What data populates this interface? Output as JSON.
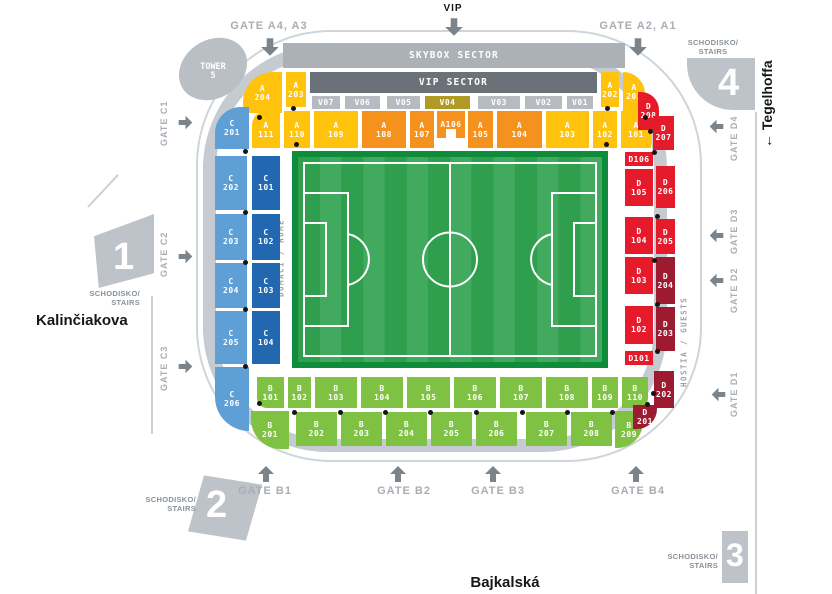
{
  "palette": {
    "yellow": "#FFC20D",
    "orange": "#F5921E",
    "olive": "#AE9A24",
    "blue_light": "#5EA0D6",
    "blue_dark": "#2268B0",
    "red": "#E51B2C",
    "maroon": "#9C1B31",
    "green": "#7EC143",
    "gray": "#B5BBC1",
    "gray_dark": "#6B7178",
    "pitch_frame": "#0E8C3C",
    "pitch_dark": "#2F9F4D",
    "pitch_light": "#42AA5E"
  },
  "streets": {
    "left": "Kalinčiakova",
    "bottom": "Bajkalská",
    "right": "← Tegelhoffa"
  },
  "vip_entrance": "VIP",
  "top_gates": {
    "left": "GATE A4, A3",
    "right": "GATE A2, A1"
  },
  "bars": {
    "skybox": "SKYBOX SECTOR",
    "vip": "VIP SECTOR"
  },
  "tower": {
    "line1": "TOWER",
    "line2": "5"
  },
  "stairs": {
    "label": "SCHODISKO/\nSTAIRS",
    "one": "1",
    "two": "2",
    "three": "3",
    "four": "4"
  },
  "side_gates": {
    "c": [
      "GATE C1",
      "GATE C2",
      "GATE C3"
    ],
    "d": [
      "GATE D4",
      "GATE D3",
      "GATE D2",
      "GATE D1"
    ],
    "b": [
      "GATE B1",
      "GATE B2",
      "GATE B3",
      "GATE B4"
    ]
  },
  "team_sides": {
    "home": "DOMÁCI / HOME",
    "guests": "HOSTIA / GUESTS"
  },
  "sections": [
    {
      "id": "A204",
      "label": "A 204",
      "color": "yellow"
    },
    {
      "id": "A203",
      "label": "A 203",
      "color": "yellow"
    },
    {
      "id": "A202",
      "label": "A 202",
      "color": "yellow"
    },
    {
      "id": "A201",
      "label": "A 201",
      "color": "yellow"
    },
    {
      "id": "A111",
      "label": "A 111",
      "color": "yellow"
    },
    {
      "id": "A110",
      "label": "A 110",
      "color": "yellow"
    },
    {
      "id": "A109",
      "label": "A 109",
      "color": "yellow"
    },
    {
      "id": "A108",
      "label": "A 108",
      "color": "orange"
    },
    {
      "id": "A107",
      "label": "A 107",
      "color": "orange"
    },
    {
      "id": "A106",
      "label": "A106",
      "color": "orange"
    },
    {
      "id": "A105",
      "label": "A 105",
      "color": "orange"
    },
    {
      "id": "A104",
      "label": "A 104",
      "color": "orange"
    },
    {
      "id": "A103",
      "label": "A 103",
      "color": "yellow"
    },
    {
      "id": "A102",
      "label": "A 102",
      "color": "yellow"
    },
    {
      "id": "A101",
      "label": "A 101",
      "color": "yellow"
    },
    {
      "id": "V07",
      "label": "V07",
      "color": "gray"
    },
    {
      "id": "V06",
      "label": "V06",
      "color": "gray"
    },
    {
      "id": "V05",
      "label": "V05",
      "color": "gray"
    },
    {
      "id": "V04",
      "label": "V04",
      "color": "olive"
    },
    {
      "id": "V03",
      "label": "V03",
      "color": "gray"
    },
    {
      "id": "V02",
      "label": "V02",
      "color": "gray"
    },
    {
      "id": "V01",
      "label": "V01",
      "color": "gray"
    },
    {
      "id": "C201",
      "label": "C 201",
      "color": "blue_light"
    },
    {
      "id": "C202",
      "label": "C 202",
      "color": "blue_light"
    },
    {
      "id": "C203",
      "label": "C 203",
      "color": "blue_light"
    },
    {
      "id": "C204",
      "label": "C 204",
      "color": "blue_light"
    },
    {
      "id": "C205",
      "label": "C 205",
      "color": "blue_light"
    },
    {
      "id": "C206",
      "label": "C 206",
      "color": "blue_light"
    },
    {
      "id": "C101",
      "label": "C 101",
      "color": "blue_dark"
    },
    {
      "id": "C102",
      "label": "C 102",
      "color": "blue_dark"
    },
    {
      "id": "C103",
      "label": "C 103",
      "color": "blue_dark"
    },
    {
      "id": "C104",
      "label": "C 104",
      "color": "blue_dark"
    },
    {
      "id": "B101",
      "label": "B 101",
      "color": "green"
    },
    {
      "id": "B102",
      "label": "B 102",
      "color": "green"
    },
    {
      "id": "B103",
      "label": "B 103",
      "color": "green"
    },
    {
      "id": "B104",
      "label": "B 104",
      "color": "green"
    },
    {
      "id": "B105",
      "label": "B 105",
      "color": "green"
    },
    {
      "id": "B106",
      "label": "B 106",
      "color": "green"
    },
    {
      "id": "B107",
      "label": "B 107",
      "color": "green"
    },
    {
      "id": "B108",
      "label": "B 108",
      "color": "green"
    },
    {
      "id": "B109",
      "label": "B 109",
      "color": "green"
    },
    {
      "id": "B110",
      "label": "B 110",
      "color": "green"
    },
    {
      "id": "B201",
      "label": "B 201",
      "color": "green"
    },
    {
      "id": "B202",
      "label": "B 202",
      "color": "green"
    },
    {
      "id": "B203",
      "label": "B 203",
      "color": "green"
    },
    {
      "id": "B204",
      "label": "B 204",
      "color": "green"
    },
    {
      "id": "B205",
      "label": "B 205",
      "color": "green"
    },
    {
      "id": "B206",
      "label": "B 206",
      "color": "green"
    },
    {
      "id": "B207",
      "label": "B 207",
      "color": "green"
    },
    {
      "id": "B208",
      "label": "B 208",
      "color": "green"
    },
    {
      "id": "B209",
      "label": "B 209",
      "color": "green"
    },
    {
      "id": "D106",
      "label": "D106",
      "color": "red"
    },
    {
      "id": "D105",
      "label": "D 105",
      "color": "red"
    },
    {
      "id": "D104",
      "label": "D 104",
      "color": "red"
    },
    {
      "id": "D103",
      "label": "D 103",
      "color": "red"
    },
    {
      "id": "D102",
      "label": "D 102",
      "color": "red"
    },
    {
      "id": "D101",
      "label": "D101",
      "color": "red"
    },
    {
      "id": "D208",
      "label": "D 208",
      "color": "red"
    },
    {
      "id": "D207",
      "label": "D 207",
      "color": "red"
    },
    {
      "id": "D206",
      "label": "D 206",
      "color": "red"
    },
    {
      "id": "D205",
      "label": "D 205",
      "color": "red"
    },
    {
      "id": "D204",
      "label": "D 204",
      "color": "maroon"
    },
    {
      "id": "D203",
      "label": "D 203",
      "color": "maroon"
    },
    {
      "id": "D202",
      "label": "D 202",
      "color": "maroon"
    },
    {
      "id": "D201",
      "label": "D 201",
      "color": "maroon"
    }
  ]
}
